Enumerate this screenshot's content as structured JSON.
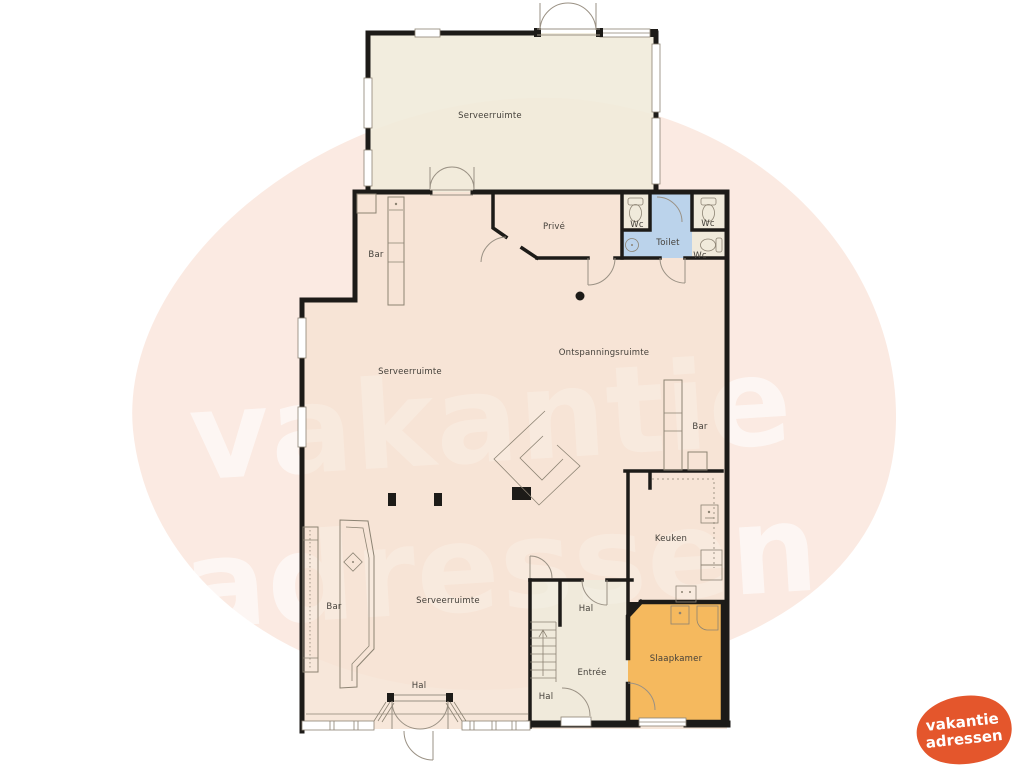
{
  "watermark": {
    "line1": "vakantie",
    "line2": "adressen"
  },
  "logo": {
    "line1": "vakantie",
    "line2": "adressen",
    "color": "#e4562c"
  },
  "colors": {
    "blob": "#fbeae2",
    "floor": "#f6e3d4",
    "floor_top_room": "#f0ead9",
    "floor_hall": "#efeadb",
    "toilet_blue": "#b7d2ec",
    "slaapkamer_orange": "#f5b95e",
    "wall": "#1d1b18",
    "furniture": "#8c8373",
    "watermark_white": "#ffffff"
  },
  "rooms": {
    "serveerruimte_top": {
      "label": "Serveerruimte"
    },
    "prive": {
      "label": "Privé"
    },
    "wc_left": {
      "label": "Wc"
    },
    "toilet": {
      "label": "Toilet"
    },
    "wc_right": {
      "label": "Wc"
    },
    "wc_bottom": {
      "label": "Wc"
    },
    "bar_top": {
      "label": "Bar"
    },
    "serveerruimte_mid": {
      "label": "Serveerruimte"
    },
    "ontspanningsruimte": {
      "label": "Ontspanningsruimte"
    },
    "bar_right": {
      "label": "Bar"
    },
    "keuken": {
      "label": "Keuken"
    },
    "bar_bottom": {
      "label": "Bar"
    },
    "serveerruimte_bottom": {
      "label": "Serveerruimte"
    },
    "hal_mid": {
      "label": "Hal"
    },
    "entree": {
      "label": "Entrée"
    },
    "slaapkamer": {
      "label": "Slaapkamer"
    },
    "hal_entry": {
      "label": "Hal"
    },
    "hal_stairs": {
      "label": "Hal"
    }
  }
}
